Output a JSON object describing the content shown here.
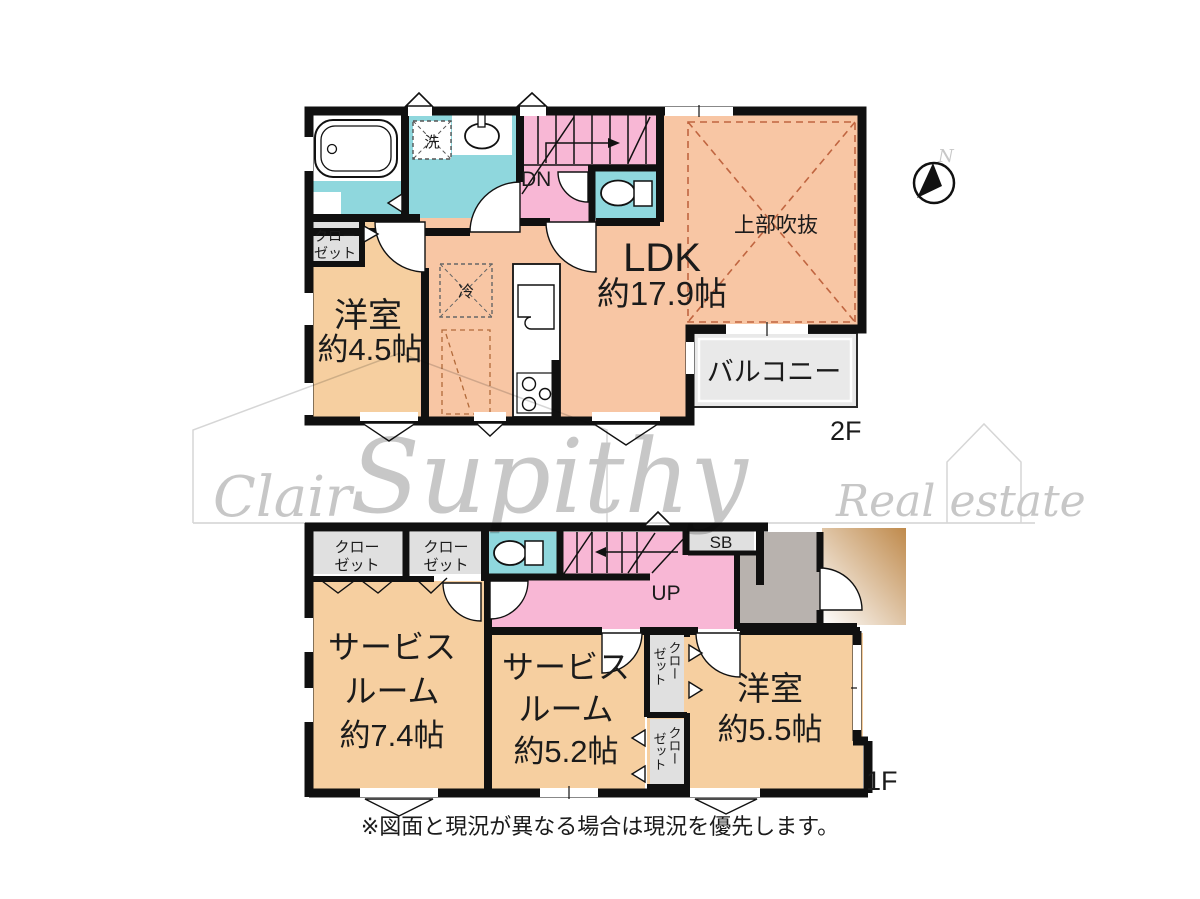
{
  "floor2": {
    "label": "2F",
    "ldk_name": "LDK",
    "ldk_size": "約17.9帖",
    "yoshitsu_name": "洋室",
    "yoshitsu_size": "約4.5帖",
    "void_label": "上部吹抜",
    "balcony_label": "バルコニー",
    "stairs_label": "DN",
    "laundry_label": "洗",
    "fridge_label": "冷"
  },
  "floor1": {
    "label": "1F",
    "service_line1": "サービス",
    "service_line2": "ルーム",
    "service1_size": "約7.4帖",
    "service2_size": "約5.2帖",
    "yoshitsu_name": "洋室",
    "yoshitsu_size": "約5.5帖",
    "stairs_label": "UP",
    "shoebox_label": "SB"
  },
  "shared": {
    "closet_line1": "クロー",
    "closet_line2": "ゼット",
    "north_label": "N"
  },
  "watermark": {
    "left": "Clair",
    "brand": "Supithy",
    "right": "Real estate"
  },
  "footer": {
    "note": "※図面と現況が異なる場合は現況を優先します。"
  },
  "colors": {
    "room_orange": "#f6cfa0",
    "ldk_salmon": "#f8c6a4",
    "wet_cyan": "#8fd7dd",
    "hall_pink": "#f8b7d5",
    "closet_gray": "#e0e0e0",
    "genkan_gray": "#b8b2ae",
    "balcony_gray": "#e9e9e9",
    "porch_brown": "#bf8a4c",
    "wall_black": "#101010",
    "void_dash": "#c06540",
    "watermark_gray": "#c7c7c7"
  }
}
